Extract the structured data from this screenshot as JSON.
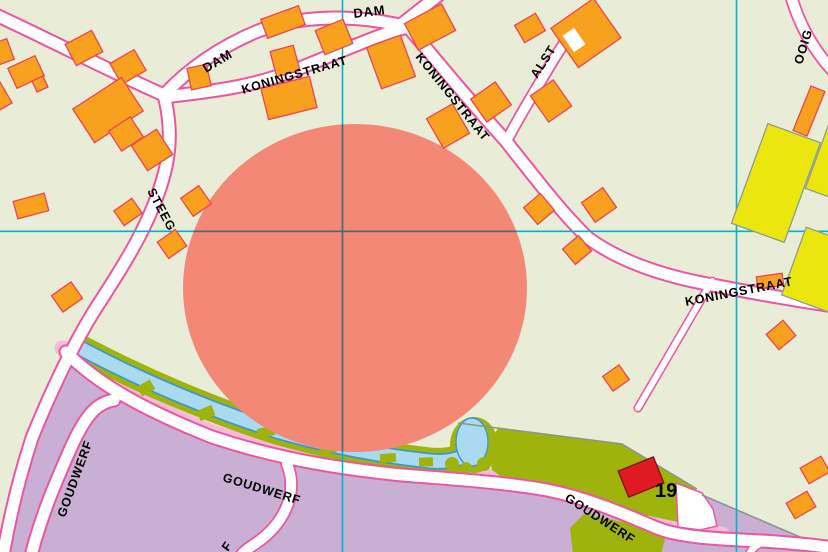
{
  "map": {
    "title": "topographic-street-map",
    "colors": {
      "background": "#e9edd8",
      "highlight": "#f48877",
      "building_fill": "#f7a11f",
      "building_stroke": "#ee4454",
      "road_fill": "#ffffff",
      "road_casing": "#ee55a0",
      "industrial_area": "#c9afd3",
      "yellow_building": "#ebe70e",
      "yellow_stroke": "#8f9b8f",
      "water": "#a9daf2",
      "water_stroke": "#3d97cd",
      "bank_green": "#9eb40d",
      "parcel_green": "#9eb40d",
      "sidewalk_pink": "#f7bad9",
      "red_building": "#df1a21",
      "red_building_stroke": "#7e1114",
      "boundary_gray": "#8c9490",
      "grid_line": "#00b4cb",
      "grid_over_circle": "#566570",
      "label_color": "#000000"
    },
    "grid": {
      "vertical_x": [
        342.5,
        736.5
      ],
      "horizontal_y": [
        231.3
      ],
      "circle_overlay_segments": {
        "vertical": {
          "x": 342.5,
          "y1": 124.4,
          "y2": 451.6
        },
        "horizontal": {
          "y": 231.3,
          "x1": 193.6,
          "x2": 516.4
        }
      }
    },
    "highlight_circle": {
      "cx": 355,
      "cy": 288,
      "rx": 172,
      "ry": 164
    },
    "street_labels": [
      {
        "text": "DAM",
        "x": 206,
        "y": 73,
        "rot": -31,
        "size": 13
      },
      {
        "text": "DAM",
        "x": 354,
        "y": 18,
        "rot": -7,
        "size": 13
      },
      {
        "text": "KONINGSTRAAT",
        "x": 243,
        "y": 94,
        "rot": -16,
        "size": 12.5
      },
      {
        "text": "KONINGSTRAAT",
        "x": 415,
        "y": 57,
        "rot": 51,
        "size": 12.5
      },
      {
        "text": "ALST",
        "x": 537,
        "y": 79,
        "rot": -57,
        "size": 12.5
      },
      {
        "text": "KONINGSTRAAT",
        "x": 686,
        "y": 306,
        "rot": -11,
        "size": 12.5
      },
      {
        "text": "STEEG",
        "x": 147,
        "y": 191,
        "rot": 62,
        "size": 12.5
      },
      {
        "text": "GOUDWERF",
        "x": 65,
        "y": 518,
        "rot": -70,
        "size": 12.5
      },
      {
        "text": "GOUDWERF",
        "x": 222,
        "y": 481,
        "rot": 17,
        "size": 12.5
      },
      {
        "text": "GOUDWERF",
        "x": 564,
        "y": 500,
        "rot": 33,
        "size": 12.5
      },
      {
        "text": "F",
        "x": 228,
        "y": 552,
        "rot": -55,
        "size": 12.5
      },
      {
        "text": "OOIG",
        "x": 802,
        "y": 65,
        "rot": -73,
        "size": 12.5
      }
    ],
    "house_number": {
      "text": "19",
      "x": 655,
      "y": 497,
      "size": 20
    },
    "roads": [
      {
        "id": "dam-west",
        "d": "M -6,14 C 50,40 120,76 164,95",
        "w": 11,
        "c": 15
      },
      {
        "id": "dam",
        "d": "M 164,95 C 190,67 222,46 258,31 C 300,15 356,14 408,27",
        "w": 11,
        "c": 15
      },
      {
        "id": "dam-north-exit",
        "d": "M 402,24 L 440,-6",
        "w": 11,
        "c": 15
      },
      {
        "id": "koningstraat-west",
        "d": "M 164,97 C 205,92 252,88 300,68 C 340,52 385,32 408,27",
        "w": 11,
        "c": 15
      },
      {
        "id": "koningstraat-east",
        "d": "M 408,27 C 428,50 465,96 505,140 C 540,184 562,213 588,238 C 614,257 652,273 702,283 C 748,292 792,300 834,306",
        "w": 11,
        "c": 15
      },
      {
        "id": "steeg",
        "d": "M 164,95 C 173,130 170,160 159,191 C 145,232 122,268 96,308 C 72,346 48,398 32,438 C 20,475 10,515 3,556",
        "w": 11,
        "c": 15
      },
      {
        "id": "alst",
        "d": "M 506,142 C 520,115 536,89 551,64 C 558,52 565,42 571,33",
        "w": 9,
        "c": 12.5
      },
      {
        "id": "ooig",
        "d": "M 791,-4 C 799,24 812,48 832,70",
        "w": 10,
        "c": 13.5
      },
      {
        "id": "goudwerf",
        "d": "M 66,352 C 100,387 152,413 212,437 C 272,457 332,468 402,475 C 452,479 502,482 547,490 C 587,498 622,513 657,528 C 682,538 722,539 762,541 C 792,543 814,545 834,548",
        "w": 11,
        "c": 15
      },
      {
        "id": "goudwerf-west",
        "d": "M 114,400 C 96,403 86,416 73,443 C 56,481 41,516 31,556",
        "w": 11,
        "c": 15
      },
      {
        "id": "branch-south",
        "d": "M 287,464 C 298,491 286,519 263,538 C 253,546 245,549 239,558",
        "w": 10,
        "c": 13.5
      },
      {
        "id": "lane-north",
        "d": "M 712,281 L 638,408",
        "w": 6,
        "c": 9
      },
      {
        "id": "stub-southeast",
        "d": "M 764,541 C 756,545 751,548 749,557",
        "w": 7,
        "c": 10
      }
    ],
    "sidewalk_strip": {
      "d": "M 62,348 C 98,381 150,407 210,431 C 270,451 332,462 402,469 C 452,473 504,476 549,484 C 589,492 624,507 659,522 C 680,530 702,533 722,534",
      "w": 15
    },
    "water": {
      "channel_d": "M 80,348 C 140,380 210,410 280,432 C 340,449 392,457 430,461 C 452,463 466,457 474,449",
      "bank_w": 27,
      "outline_w": 16.5,
      "water_w": 13,
      "pond_bank": {
        "cx": 474,
        "cy": 445,
        "rx": 24,
        "ry": 28
      },
      "pond_water": {
        "cx": 472,
        "cy": 442,
        "rx": 16,
        "ry": 24
      },
      "bank_bumps": [
        [
          452,
          464,
          7
        ],
        [
          466,
          468,
          6
        ],
        [
          484,
          464,
          7
        ],
        [
          496,
          454,
          6
        ]
      ],
      "bank_notches": [
        [
          146,
          388,
          15,
          11,
          -30
        ],
        [
          206,
          413,
          16,
          11,
          -22
        ],
        [
          266,
          432,
          17,
          10,
          -15
        ],
        [
          328,
          448,
          17,
          10,
          -8
        ],
        [
          388,
          458,
          16,
          9,
          -4
        ],
        [
          426,
          462,
          14,
          9,
          -2
        ]
      ]
    },
    "regions": {
      "industrial_main": "66,352 102,388 160,415 220,439 282,458 342,469 402,476 462,482 522,488 562,496 602,509 644,524 672,534 704,538 744,540 794,543 832,548 832,556 -4,556 -4,552 2,548 10,506 22,462 38,418 54,378",
      "industrial_wedge": "702,495 814,543 780,539 740,536 704,530 688,526",
      "parcel_19": "498,428 622,444 697,489 678,494 678,522 640,514 600,500 558,491 510,483 492,470 489,452 493,437",
      "green_south": "584,514 667,531 661,554 573,554 570,528",
      "white_yard": "676,483 702,493 713,509 717,526 700,530 678,527"
    },
    "boundary_lines": [
      "458,423 560,436 622,444 697,489",
      "702,495 814,543"
    ],
    "buildings": {
      "orange": [
        [
          2,
          52,
          18,
          22,
          -20
        ],
        [
          26,
          72,
          30,
          22,
          -25
        ],
        [
          40,
          84,
          12,
          12,
          -25
        ],
        [
          84,
          48,
          30,
          24,
          -28
        ],
        [
          0,
          96,
          14,
          24,
          -30
        ],
        [
          128,
          67,
          28,
          24,
          -30
        ],
        [
          108,
          110,
          58,
          40,
          -33
        ],
        [
          126,
          134,
          26,
          24,
          -33
        ],
        [
          152,
          150,
          30,
          30,
          -33
        ],
        [
          199,
          77,
          20,
          22,
          -12
        ],
        [
          285,
          61,
          24,
          26,
          -15
        ],
        [
          289,
          98,
          50,
          32,
          -14
        ],
        [
          283,
          22,
          40,
          20,
          -20
        ],
        [
          334,
          37,
          30,
          26,
          -22
        ],
        [
          391,
          62,
          36,
          44,
          -20
        ],
        [
          430,
          27,
          42,
          30,
          -28
        ],
        [
          448,
          126,
          30,
          34,
          -30
        ],
        [
          491,
          102,
          30,
          28,
          -35
        ],
        [
          530,
          28,
          24,
          20,
          -30
        ],
        [
          586,
          33,
          52,
          48,
          -35
        ],
        [
          551,
          101,
          28,
          32,
          -35
        ],
        [
          539,
          209,
          22,
          22,
          -40
        ],
        [
          599,
          205,
          26,
          24,
          -35
        ],
        [
          577,
          250,
          21,
          20,
          -40
        ],
        [
          616,
          378,
          20,
          18,
          -35
        ],
        [
          770,
          281,
          26,
          12,
          -8
        ],
        [
          781,
          335,
          22,
          20,
          -40
        ],
        [
          815,
          470,
          24,
          18,
          -30
        ],
        [
          801,
          505,
          24,
          18,
          -30
        ],
        [
          128,
          212,
          22,
          18,
          -35
        ],
        [
          31,
          206,
          32,
          18,
          -15
        ],
        [
          172,
          244,
          22,
          20,
          -35
        ],
        [
          196,
          201,
          22,
          22,
          -35
        ],
        [
          67,
          297,
          24,
          20,
          -35
        ],
        [
          809,
          111,
          15,
          48,
          22
        ]
      ],
      "yellow": [
        [
          776,
          183,
          56,
          106,
          20
        ],
        [
          838,
          163,
          44,
          70,
          20
        ],
        [
          824,
          272,
          64,
          72,
          20
        ]
      ],
      "red": [
        641,
        477,
        38,
        28,
        -22
      ],
      "white_notch": [
        574,
        40,
        14,
        20,
        -35
      ]
    }
  }
}
